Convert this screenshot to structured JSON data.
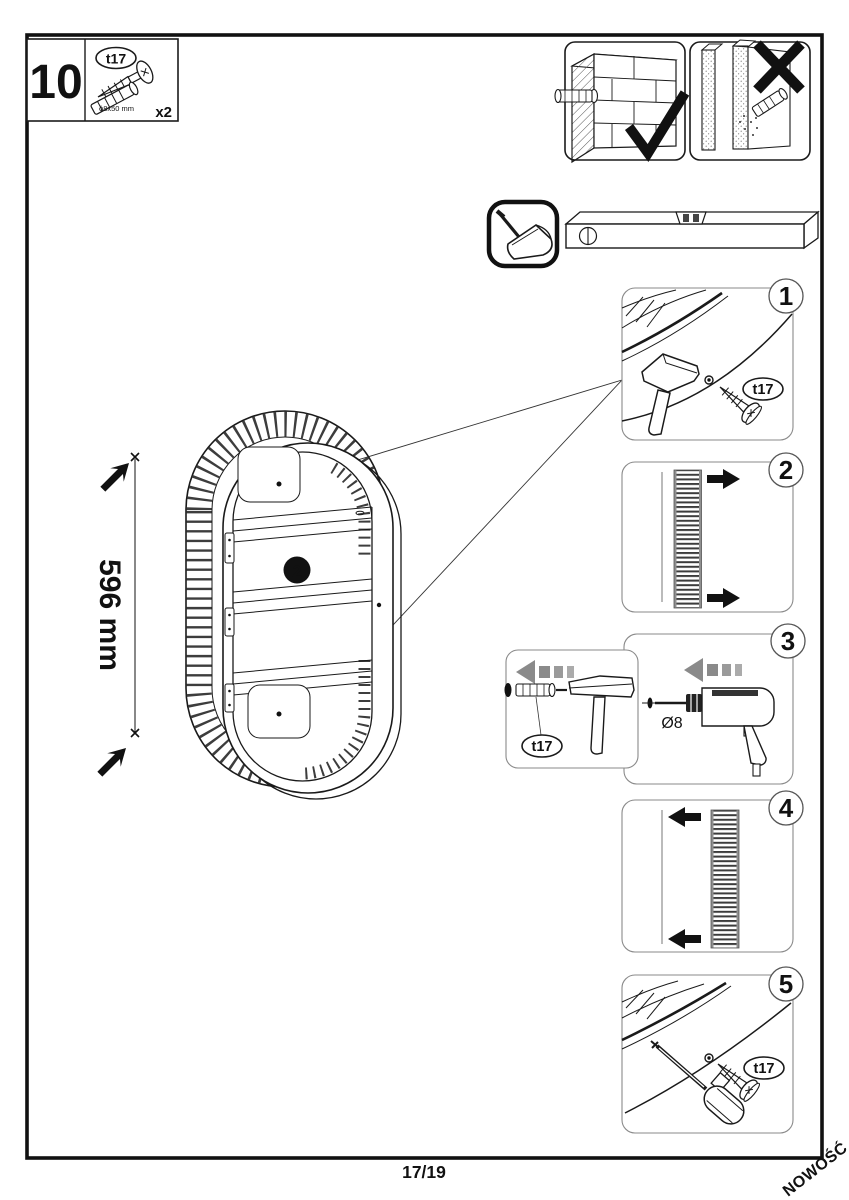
{
  "page": {
    "number": "17/19",
    "watermark": "NOWOŚĆ"
  },
  "step": {
    "number": "10"
  },
  "hardware_box": {
    "part_code": "t17",
    "part_size": "ϕ8x50 mm",
    "quantity": "x2"
  },
  "main_view": {
    "dimension": "596 mm",
    "marker": "2"
  },
  "callouts": {
    "s1": {
      "number": "1",
      "part": "t17"
    },
    "s2": {
      "number": "2"
    },
    "s3": {
      "number": "3",
      "part": "t17",
      "drill_dia": "Ø8"
    },
    "s4": {
      "number": "4"
    },
    "s5": {
      "number": "5",
      "part": "t17"
    }
  },
  "colors": {
    "accent_red": "#e30613",
    "gray_arrow": "#8f8f8f"
  }
}
